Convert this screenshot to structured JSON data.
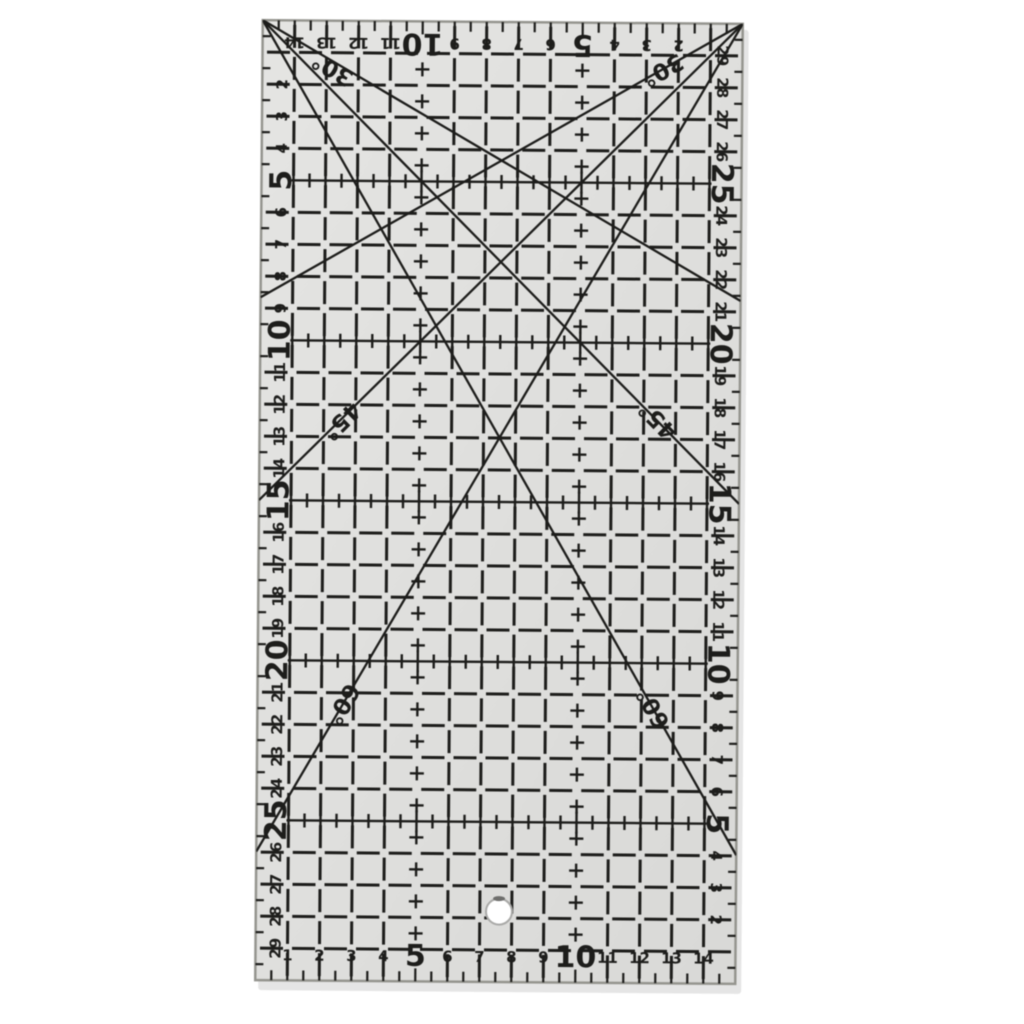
{
  "ruler": {
    "grid": {
      "columns_cm": 15,
      "rows_cm": 30,
      "unit_px": 32
    },
    "colors": {
      "background": "#ffffff",
      "body": "#e5e5e3",
      "body_dark": "#d9d9d7",
      "ink": "#1d1d1b",
      "edge": "#95958f",
      "shadow": "rgba(0,0,0,0.10)",
      "hole_fill": "#ffffff",
      "hole_ring": "#a9a9a7",
      "hole_notch": "#6e6e6c"
    },
    "scales": {
      "top": {
        "numbers": [
          14,
          13,
          12,
          11,
          10,
          9,
          8,
          7,
          6,
          5,
          4,
          3,
          2
        ],
        "emphasized": [
          5,
          10
        ],
        "rotation_deg": 180
      },
      "bottom": {
        "numbers": [
          1,
          2,
          3,
          4,
          5,
          6,
          7,
          8,
          9,
          10,
          11,
          12,
          13,
          14
        ],
        "emphasized": [
          5,
          10
        ],
        "rotation_deg": 0
      },
      "left": {
        "numbers": [
          2,
          3,
          4,
          5,
          6,
          7,
          8,
          9,
          10,
          11,
          12,
          13,
          14,
          15,
          16,
          17,
          18,
          19,
          20,
          21,
          22,
          23,
          24,
          25,
          26,
          27,
          28,
          29
        ],
        "emphasized": [
          5,
          10,
          15,
          20,
          25
        ],
        "rotation_deg": -90
      },
      "right": {
        "numbers": [
          29,
          28,
          27,
          26,
          25,
          24,
          23,
          22,
          21,
          20,
          19,
          18,
          17,
          16,
          15,
          14,
          13,
          12,
          11,
          10,
          9,
          8,
          7,
          6,
          5,
          4,
          3,
          2
        ],
        "emphasized": [
          5,
          10,
          15,
          20,
          25
        ],
        "rotation_deg": 90
      }
    },
    "measuring_rows_cm": [
      5,
      10,
      15,
      20,
      25
    ],
    "cross_mark_columns_cm": [
      5,
      10
    ],
    "angle_lines": [
      {
        "label": "30°",
        "origin": "top-left",
        "angle_deg": 30,
        "label_x_cm": 2.2,
        "label_y_cm": 1.5,
        "label_rotation_deg": 210
      },
      {
        "label": "30°",
        "origin": "top-right",
        "angle_deg": 30,
        "label_x_cm": 12.5,
        "label_y_cm": 1.45,
        "label_rotation_deg": 150
      },
      {
        "label": "45°",
        "origin": "top-left",
        "angle_deg": 45,
        "label_x_cm": 12.45,
        "label_y_cm": 12.4,
        "label_rotation_deg": 225
      },
      {
        "label": "45°",
        "origin": "top-right",
        "angle_deg": 45,
        "label_x_cm": 2.55,
        "label_y_cm": 12.5,
        "label_rotation_deg": 135
      },
      {
        "label": "60°",
        "origin": "top-left",
        "angle_deg": 60,
        "label_x_cm": 12.38,
        "label_y_cm": 21.4,
        "label_rotation_deg": 240
      },
      {
        "label": "60°",
        "origin": "top-right",
        "angle_deg": 60,
        "label_x_cm": 2.65,
        "label_y_cm": 21.35,
        "label_rotation_deg": 120
      }
    ],
    "hole": {
      "x_cm": 7.6,
      "y_cm": 27.8,
      "radius_px": 13
    }
  }
}
